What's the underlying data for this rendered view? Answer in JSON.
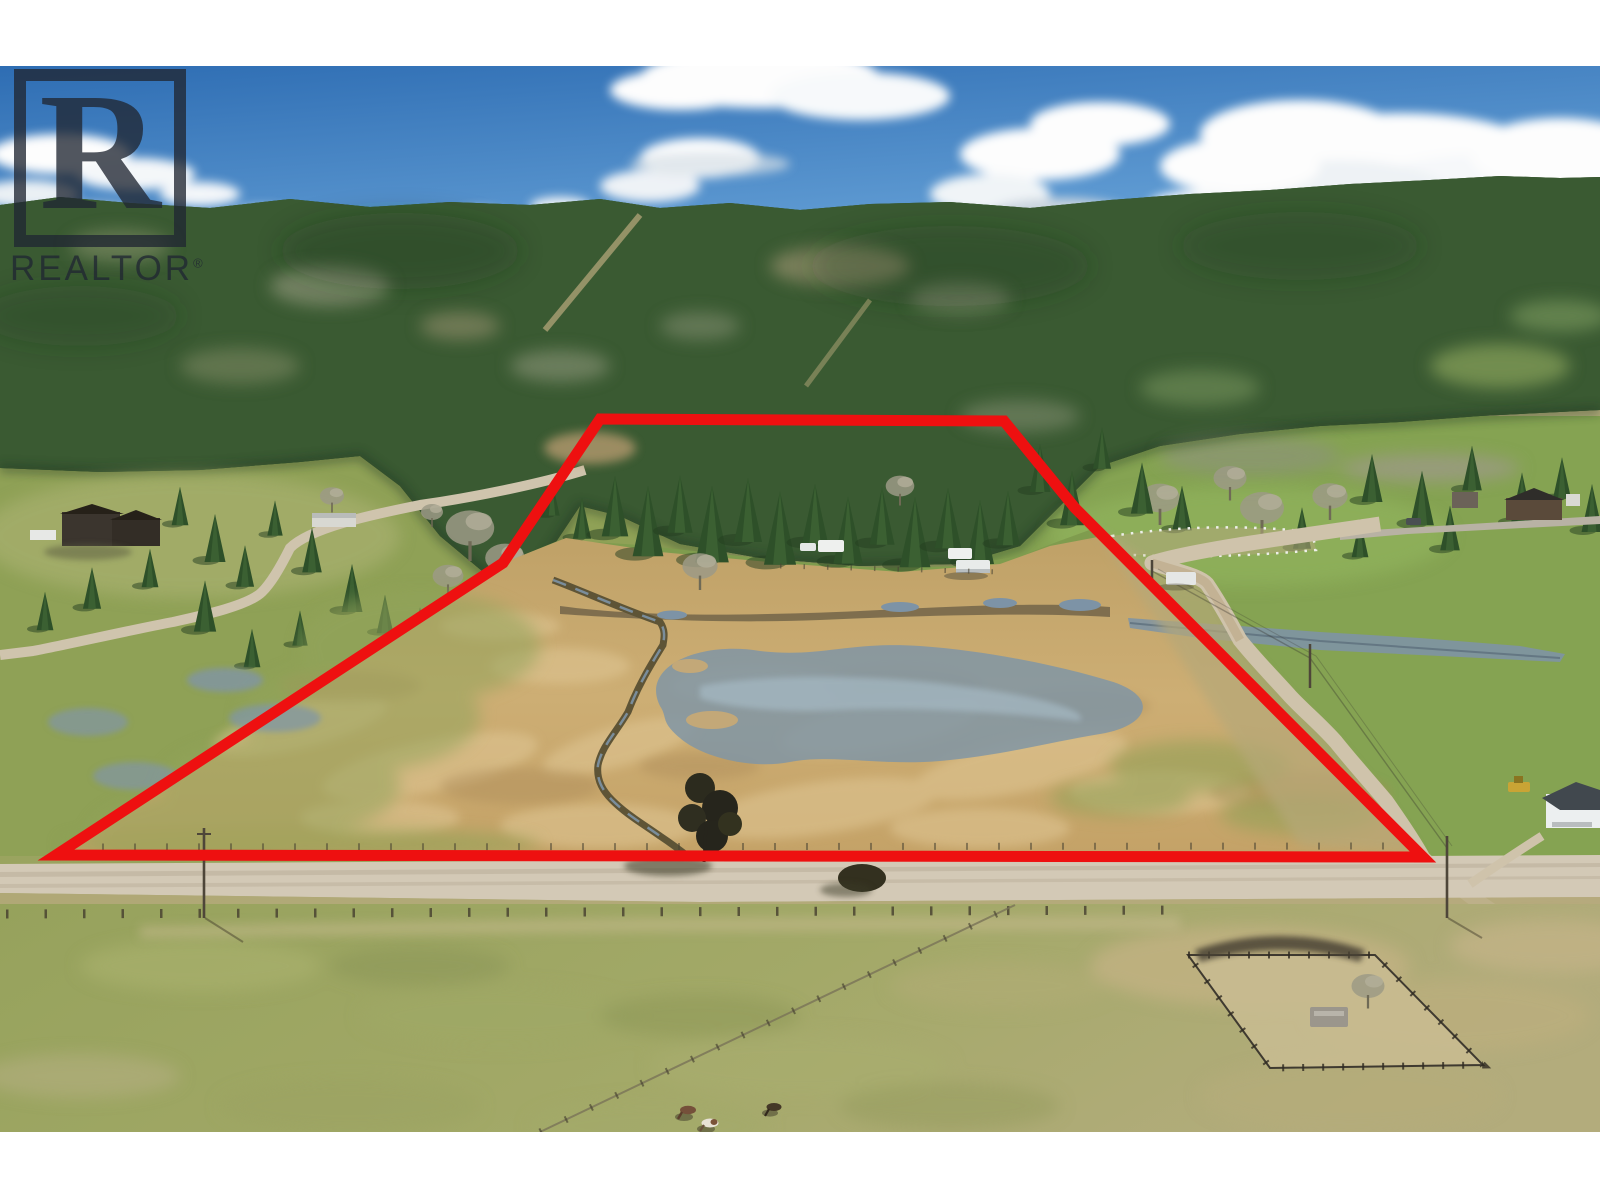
{
  "window": {
    "width": 1600,
    "height": 1200,
    "margin_color": "#ffffff"
  },
  "photo": {
    "kind": "aerial-drone-photograph",
    "subject": "rural acreage listing with red lot-line outline, forested hillside behind, gravel road and pastures in front",
    "x": 0,
    "y": 66,
    "width": 1600,
    "height": 1066
  },
  "watermark": {
    "brand": "REALTOR",
    "registered": "®",
    "logo_letter": "R",
    "color": "rgba(32,38,50,0.78)"
  },
  "boundary": {
    "points": "600,353 1004,355 1075,442 1423,791 56,789 503,497",
    "color": "#ee1010",
    "stroke_width": 11
  },
  "scene_features": [
    "blue sky with cumulus clouds",
    "forested mountain hillside",
    "logging cut lines",
    "subject property: dry tan hay field",
    "seasonal wetland ponds",
    "winding drainage creek",
    "row of conifers along north lot line",
    "white rv trailers inside property",
    "neighbour houses and mobile home (left)",
    "curving gravel lane (left)",
    "bright green pastures",
    "white-fenced round paddock (right)",
    "country road with junction",
    "diagonal gravel driveway",
    "flooded roadside ditch",
    "power poles with shadows",
    "front gravel road along south lot line",
    "fence lines with posts",
    "dirt corral paddock (bottom right)",
    "grazing horses (three)",
    "white house with dark roof (right)",
    "yellow tractor",
    "large leafless tree casting shadow"
  ],
  "palette": {
    "white_margin": "#ffffff",
    "watermark": "rgba(32,38,50,0.78)",
    "sky_top": "#2e6db3",
    "sky_mid": "#5e9ad2",
    "sky_horizon": "#c6dcee",
    "cloud": "#fdfdfd",
    "cloud_shade": "#bfccd8",
    "ridge_haze": "#a8bcCB",
    "forest_dark": "#2b4727",
    "forest_mid": "#3a5a32",
    "forest_light": "#4c6c3c",
    "grass_green": "#8fa156",
    "grass_bright": "#7f9c4e",
    "lawn_green": "#85a352",
    "field_tan": "#c9aa70",
    "field_light": "#e0c795",
    "field_dark": "#ab8a58",
    "water_gray": "#8095a5",
    "water_light": "#aabfcb",
    "mud_brown": "#6d6046",
    "road_gravel": "#d3c9b6",
    "road_dirt": "#c3b294",
    "fence_dark": "#46402f",
    "boundary_red": "#ee1010",
    "house_dark": "#3b352e",
    "white_building": "#eceff0",
    "roof_gray": "#41484e",
    "machine_yellow": "#c9a435",
    "horse_brown": "#75503a",
    "horse_paint": "#e8e2d6",
    "horse_dark": "#443827"
  }
}
